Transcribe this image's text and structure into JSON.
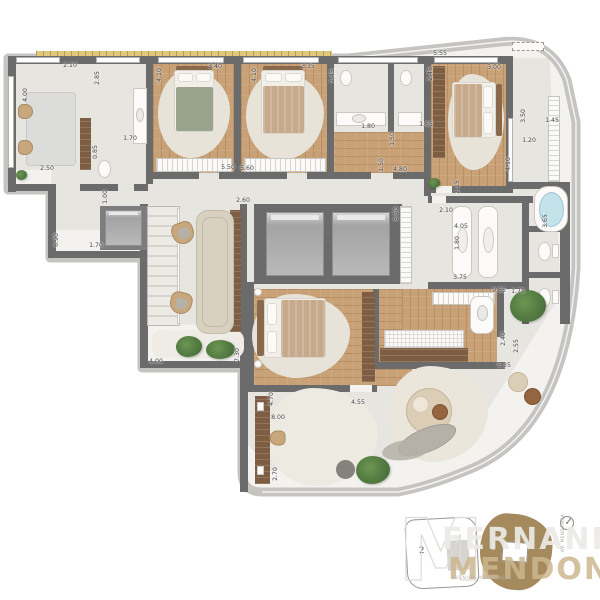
{
  "palette": {
    "wall": "#6b6b6b",
    "shell_band": "#c5c4c1",
    "marble_floor": "#f3f2ef",
    "wood_floor": "#c9a176",
    "wood_dark": "#7d5e43",
    "rug": "#e8e3d8",
    "bathtub_water": "#c3e2ea",
    "plant_green": "#4b733c",
    "keyplan_unit_fill": "#a58a5e",
    "planter_strip": "#e0c87c"
  },
  "dimensions": [
    {
      "t": "4.00",
      "x": 26,
      "y": 95,
      "v": 1
    },
    {
      "t": "2.10",
      "x": 70,
      "y": 66
    },
    {
      "t": "2.85",
      "x": 98,
      "y": 78,
      "v": 1
    },
    {
      "t": "0.85",
      "x": 96,
      "y": 152,
      "v": 1
    },
    {
      "t": "1.70",
      "x": 130,
      "y": 139
    },
    {
      "t": "2.50",
      "x": 47,
      "y": 169
    },
    {
      "t": "4.10",
      "x": 160,
      "y": 75,
      "v": 1
    },
    {
      "t": "3.40",
      "x": 215,
      "y": 67
    },
    {
      "t": "4.10",
      "x": 255,
      "y": 75,
      "v": 1
    },
    {
      "t": "3.35",
      "x": 308,
      "y": 67
    },
    {
      "t": "2.45",
      "x": 333,
      "y": 76,
      "v": 1
    },
    {
      "t": "5.50",
      "x": 228,
      "y": 168
    },
    {
      "t": "5.60",
      "x": 247,
      "y": 169
    },
    {
      "t": "1.80",
      "x": 368,
      "y": 127
    },
    {
      "t": "1.65",
      "x": 426,
      "y": 125
    },
    {
      "t": "5.55",
      "x": 440,
      "y": 54
    },
    {
      "t": "2.45",
      "x": 431,
      "y": 74,
      "v": 1
    },
    {
      "t": "3.00",
      "x": 494,
      "y": 68
    },
    {
      "t": "3.50",
      "x": 524,
      "y": 116,
      "v": 1
    },
    {
      "t": "1.45",
      "x": 552,
      "y": 121
    },
    {
      "t": "1.50",
      "x": 393,
      "y": 139,
      "v": 1
    },
    {
      "t": "1.50",
      "x": 382,
      "y": 165,
      "v": 1
    },
    {
      "t": "4.80",
      "x": 400,
      "y": 170
    },
    {
      "t": "1.00",
      "x": 106,
      "y": 197,
      "v": 1
    },
    {
      "t": "6.90",
      "x": 57,
      "y": 240,
      "v": 1
    },
    {
      "t": "1.70",
      "x": 96,
      "y": 246
    },
    {
      "t": "2.60",
      "x": 243,
      "y": 201
    },
    {
      "t": "5.50",
      "x": 397,
      "y": 214,
      "v": 1
    },
    {
      "t": "4.10",
      "x": 509,
      "y": 164,
      "v": 1
    },
    {
      "t": "1.20",
      "x": 529,
      "y": 141
    },
    {
      "t": "2.15",
      "x": 458,
      "y": 187,
      "v": 1
    },
    {
      "t": "2.10",
      "x": 446,
      "y": 211
    },
    {
      "t": "4.05",
      "x": 461,
      "y": 227
    },
    {
      "t": "1.80",
      "x": 458,
      "y": 243,
      "v": 1
    },
    {
      "t": "3.65",
      "x": 546,
      "y": 221,
      "v": 1
    },
    {
      "t": "3.75",
      "x": 460,
      "y": 278
    },
    {
      "t": "9.65",
      "x": 499,
      "y": 291
    },
    {
      "t": "1.75",
      "x": 518,
      "y": 292
    },
    {
      "t": "2.40",
      "x": 504,
      "y": 339,
      "v": 1
    },
    {
      "t": "2.55",
      "x": 517,
      "y": 346,
      "v": 1
    },
    {
      "t": "5.35",
      "x": 504,
      "y": 366
    },
    {
      "t": "4.00",
      "x": 156,
      "y": 362
    },
    {
      "t": "7.30",
      "x": 238,
      "y": 355,
      "v": 1
    },
    {
      "t": "4.70",
      "x": 272,
      "y": 399,
      "v": 1
    },
    {
      "t": "4.55",
      "x": 358,
      "y": 403
    },
    {
      "t": "8.00",
      "x": 278,
      "y": 418
    },
    {
      "t": "2.70",
      "x": 276,
      "y": 474,
      "v": 1
    }
  ],
  "watermark": {
    "line1": "FERNANDO",
    "line2": "MENDONÇA",
    "monogram": "M"
  },
  "keyplan": {
    "unit_left_label": "2",
    "unit_right_label": "1",
    "caption": "AVENIDA MENDONÇA",
    "street_side": "AV. MENDONÇA"
  }
}
